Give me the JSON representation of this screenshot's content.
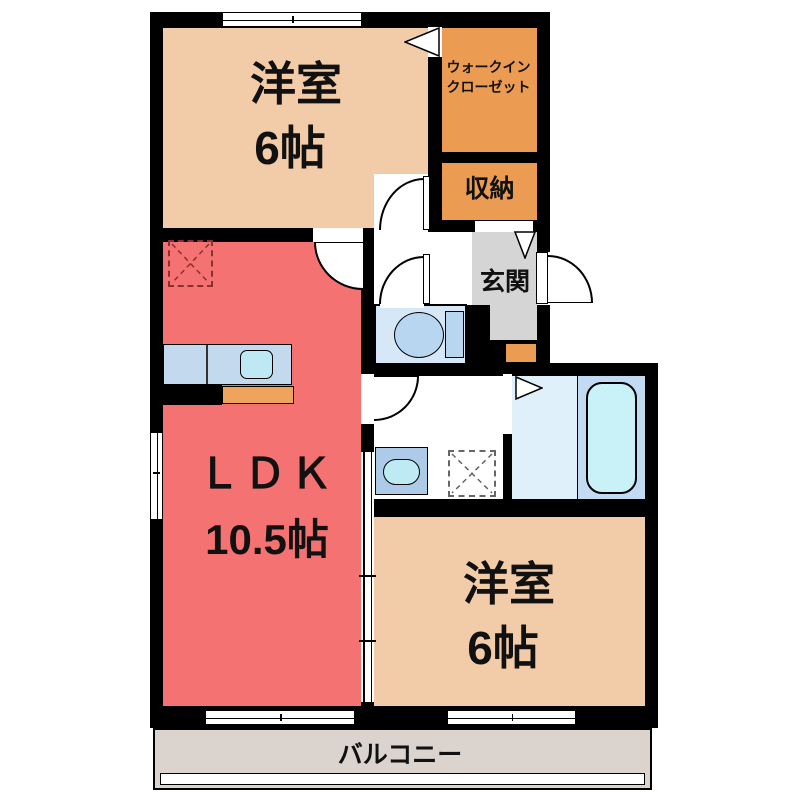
{
  "plan": {
    "type": "japanese-apartment-floorplan",
    "rooms": {
      "bedroom_top": {
        "label": "洋室",
        "size": "6帖"
      },
      "bedroom_bottom": {
        "label": "洋室",
        "size": "6帖"
      },
      "ldk": {
        "label": "ＬＤＫ",
        "size": "10.5帖"
      },
      "walk_in_closet": {
        "label_line1": "ウォークイン",
        "label_line2": "クローゼット"
      },
      "storage": {
        "label": "収納"
      },
      "entrance": {
        "label": "玄関"
      },
      "balcony": {
        "label": "バルコニー"
      }
    },
    "fixtures": [
      "kitchen-counter",
      "kitchen-sink",
      "refrigerator-space",
      "washing-machine-space",
      "washbasin",
      "toilet",
      "bathtub",
      "shoe-cabinet",
      "sliding-door",
      "hinged-doors",
      "windows",
      "entrance-step-triangle",
      "closet-door-triangle",
      "bath-door-triangle"
    ],
    "colors": {
      "wall": "#000000",
      "bedroom_tan": "#F2CBA8",
      "ldk_red": "#F57272",
      "closet_orange": "#EC9C52",
      "counter_edge_orange": "#EFA45D",
      "entrance_gray": "#D5D5D5",
      "balcony_beige": "#DBD4CE",
      "toilet_floor_blue": "#D6E8F8",
      "kitchen_counter_blue": "#C3D9EE",
      "sink_cyan": "#BEE9F4",
      "bath_floor_light": "#E0F0FB",
      "bath_floor_dark": "#C2DBF2",
      "bathtub_cyan": "#C9F1F8",
      "toilet_fixture_blue": "#B9D6F0",
      "washbasin_blue": "#ADCBE8",
      "fridge_dash": "#8B3030"
    }
  }
}
